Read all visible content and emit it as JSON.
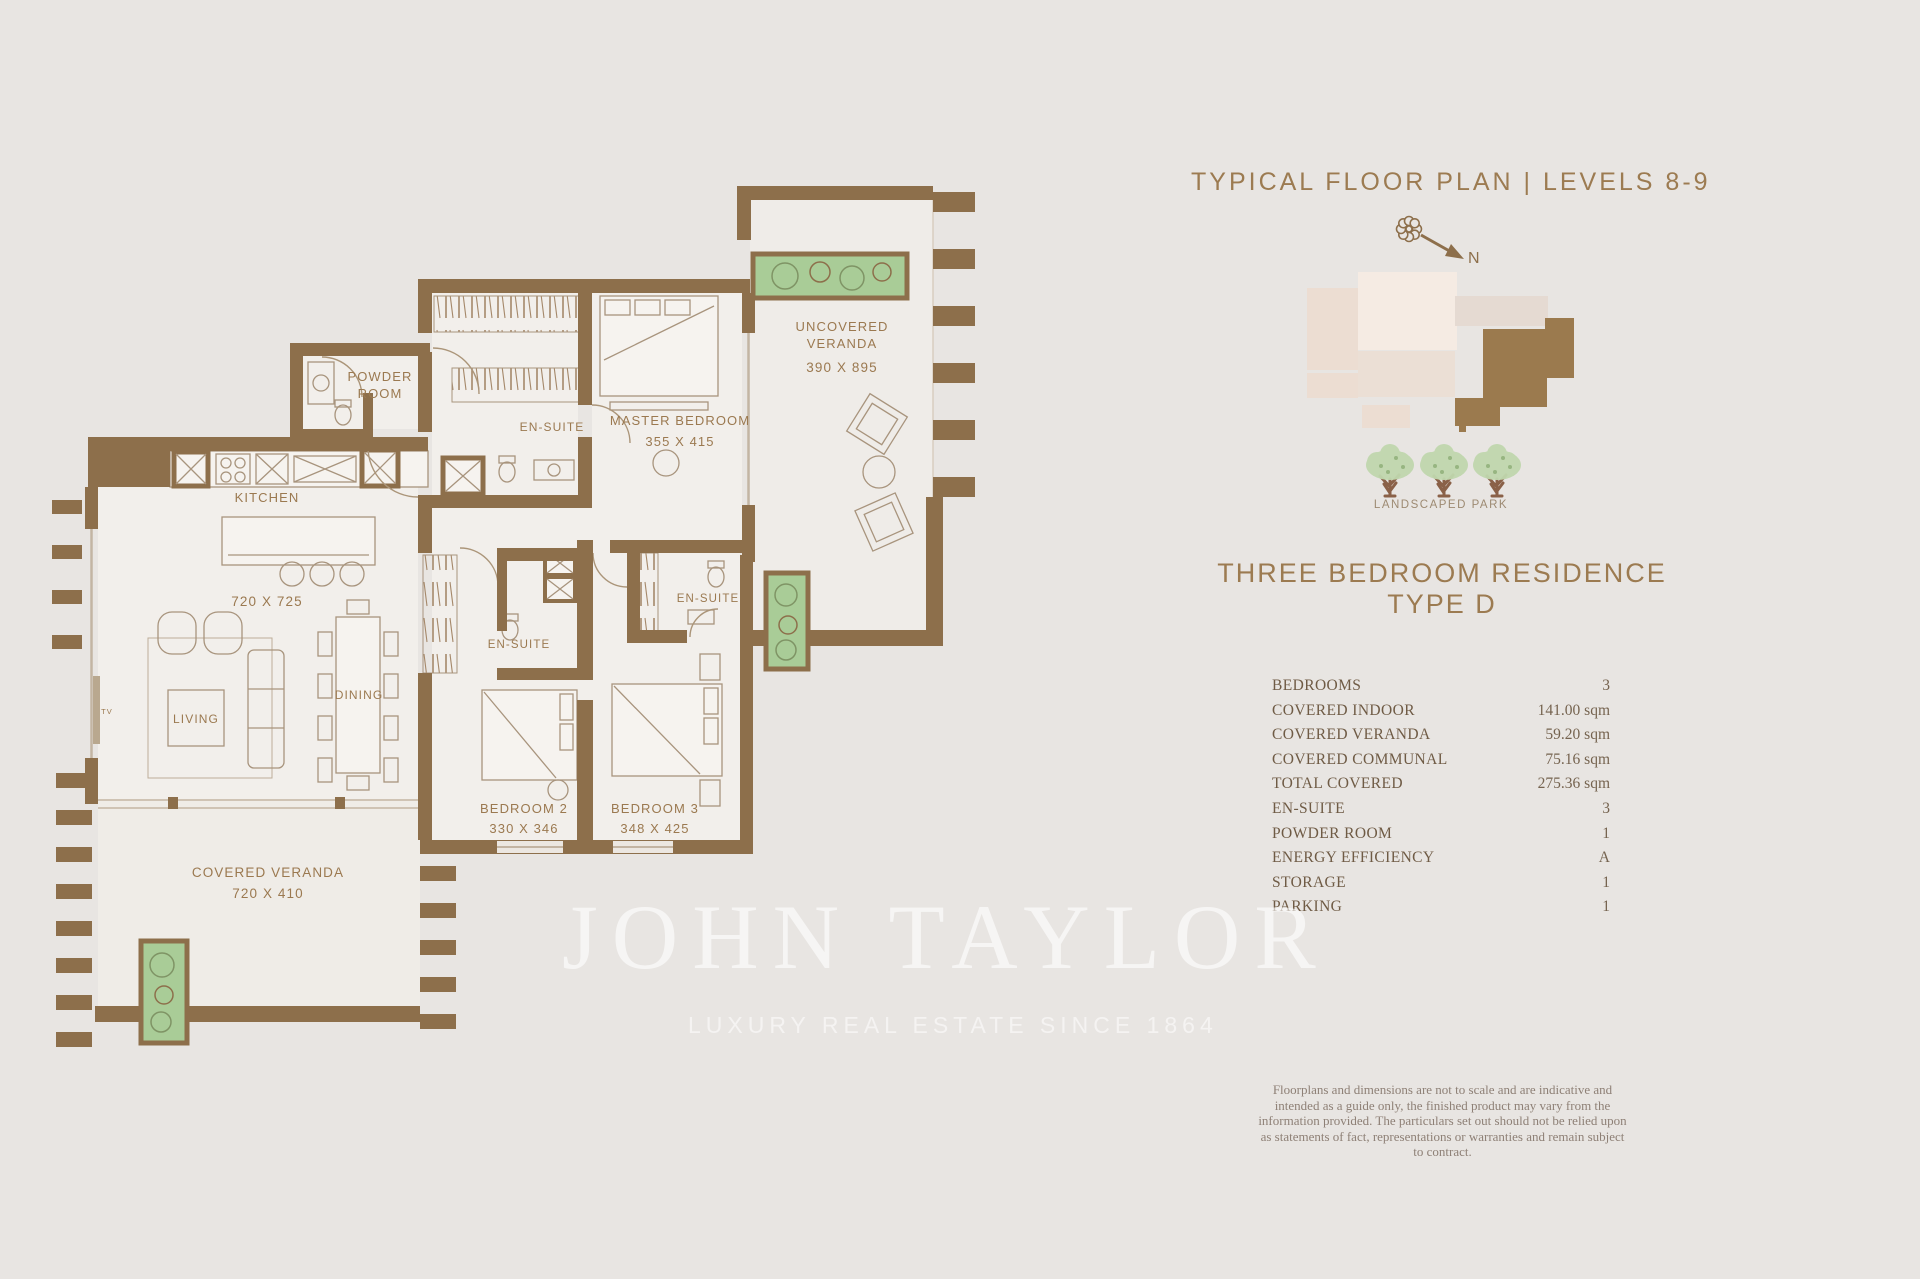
{
  "header": {
    "title": "TYPICAL FLOOR PLAN | LEVELS 8-9"
  },
  "compass": {
    "north": "N"
  },
  "site_plan": {
    "caption": "LANDSCAPED PARK"
  },
  "residence": {
    "title_line1": "THREE BEDROOM RESIDENCE",
    "title_line2": "TYPE D"
  },
  "specs": {
    "rows": [
      {
        "label": "BEDROOMS",
        "value": "3"
      },
      {
        "label": "COVERED INDOOR",
        "value": "141.00 sqm"
      },
      {
        "label": "COVERED VERANDA",
        "value": "59.20 sqm"
      },
      {
        "label": "COVERED COMMUNAL",
        "value": "75.16 sqm"
      },
      {
        "label": "TOTAL COVERED",
        "value": "275.36 sqm"
      },
      {
        "label": "EN-SUITE",
        "value": "3"
      },
      {
        "label": "POWDER ROOM",
        "value": "1"
      },
      {
        "label": "ENERGY EFFICIENCY",
        "value": "A"
      },
      {
        "label": "STORAGE",
        "value": "1"
      },
      {
        "label": "PARKING",
        "value": "1"
      }
    ]
  },
  "disclaimer": {
    "text": "Floorplans and dimensions are not to scale and are indicative and intended as a guide only, the finished product may vary from the information provided. The particulars set out should not be relied upon as statements of fact, representations or warranties and remain subject to contract."
  },
  "watermark": {
    "brand": "JOHN TAYLOR",
    "tagline": "LUXURY REAL ESTATE SINCE 1864"
  },
  "floorplan": {
    "labels": {
      "powder_line1": "POWDER",
      "powder_line2": "ROOM",
      "kitchen": "KITCHEN",
      "kitchen_dim": "720 X 725",
      "living": "LIVING",
      "dining": "DINING",
      "tv": "TV",
      "ensuite_master": "EN-SUITE",
      "ensuite_bedroom2": "EN-SUITE",
      "ensuite_bedroom3": "EN-SUITE",
      "master": "MASTER BEDROOM",
      "master_dim": "355 X 415",
      "uncovered_line1": "UNCOVERED",
      "uncovered_line2": "VERANDA",
      "uncovered_dim": "390 X 895",
      "bedroom2": "BEDROOM 2",
      "bedroom2_dim": "330 X 346",
      "bedroom3": "BEDROOM 3",
      "bedroom3_dim": "348 X 425",
      "covered": "COVERED VERANDA",
      "covered_dim": "720 X 410"
    }
  },
  "colors": {
    "background": "#e8e5e2",
    "wall_brown": "#8d6f4b",
    "accent_gold": "#9c7b51",
    "plan_floor": "#f2efeb",
    "planter_green": "#a9cc97",
    "tree_foliage": "#c0d7ae",
    "tree_trunk": "#8a6148",
    "site_cream": "#f5ebe3",
    "site_brown": "#9b7a4e",
    "spec_text": "#6f5b45",
    "watermark_white": "#ffffff"
  }
}
